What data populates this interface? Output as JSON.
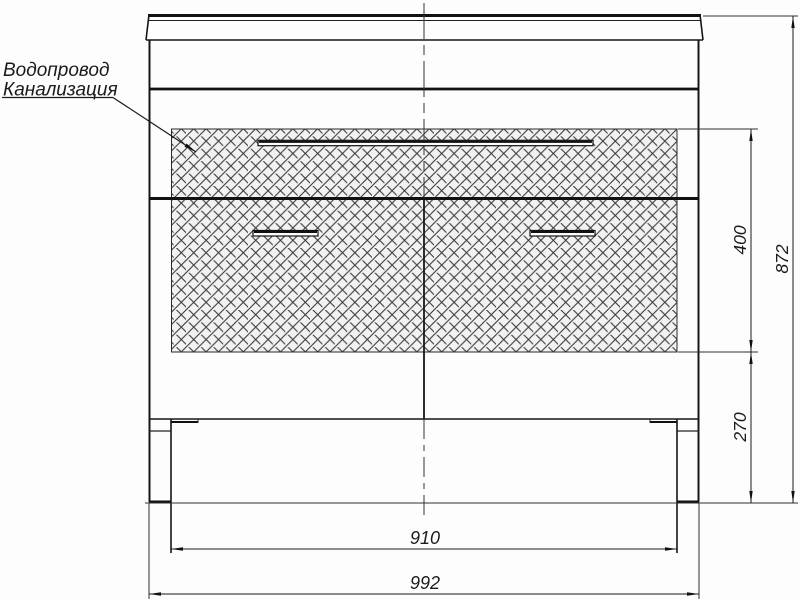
{
  "drawing": {
    "title": "vanity-cabinet-front-view",
    "callout": {
      "line1": "Водопровод",
      "line2": "Канализация"
    },
    "dimensions": {
      "zone_height": "400",
      "overall_height": "872",
      "plinth_height": "270",
      "inner_width": "910",
      "overall_width": "992"
    },
    "colors": {
      "line": "#1b1b1b",
      "thin_line": "#2e2e2e",
      "hatch_line": "#3a3a3a",
      "hatch_fill": "#f2f2f2",
      "background": "#fdfdfd"
    }
  }
}
